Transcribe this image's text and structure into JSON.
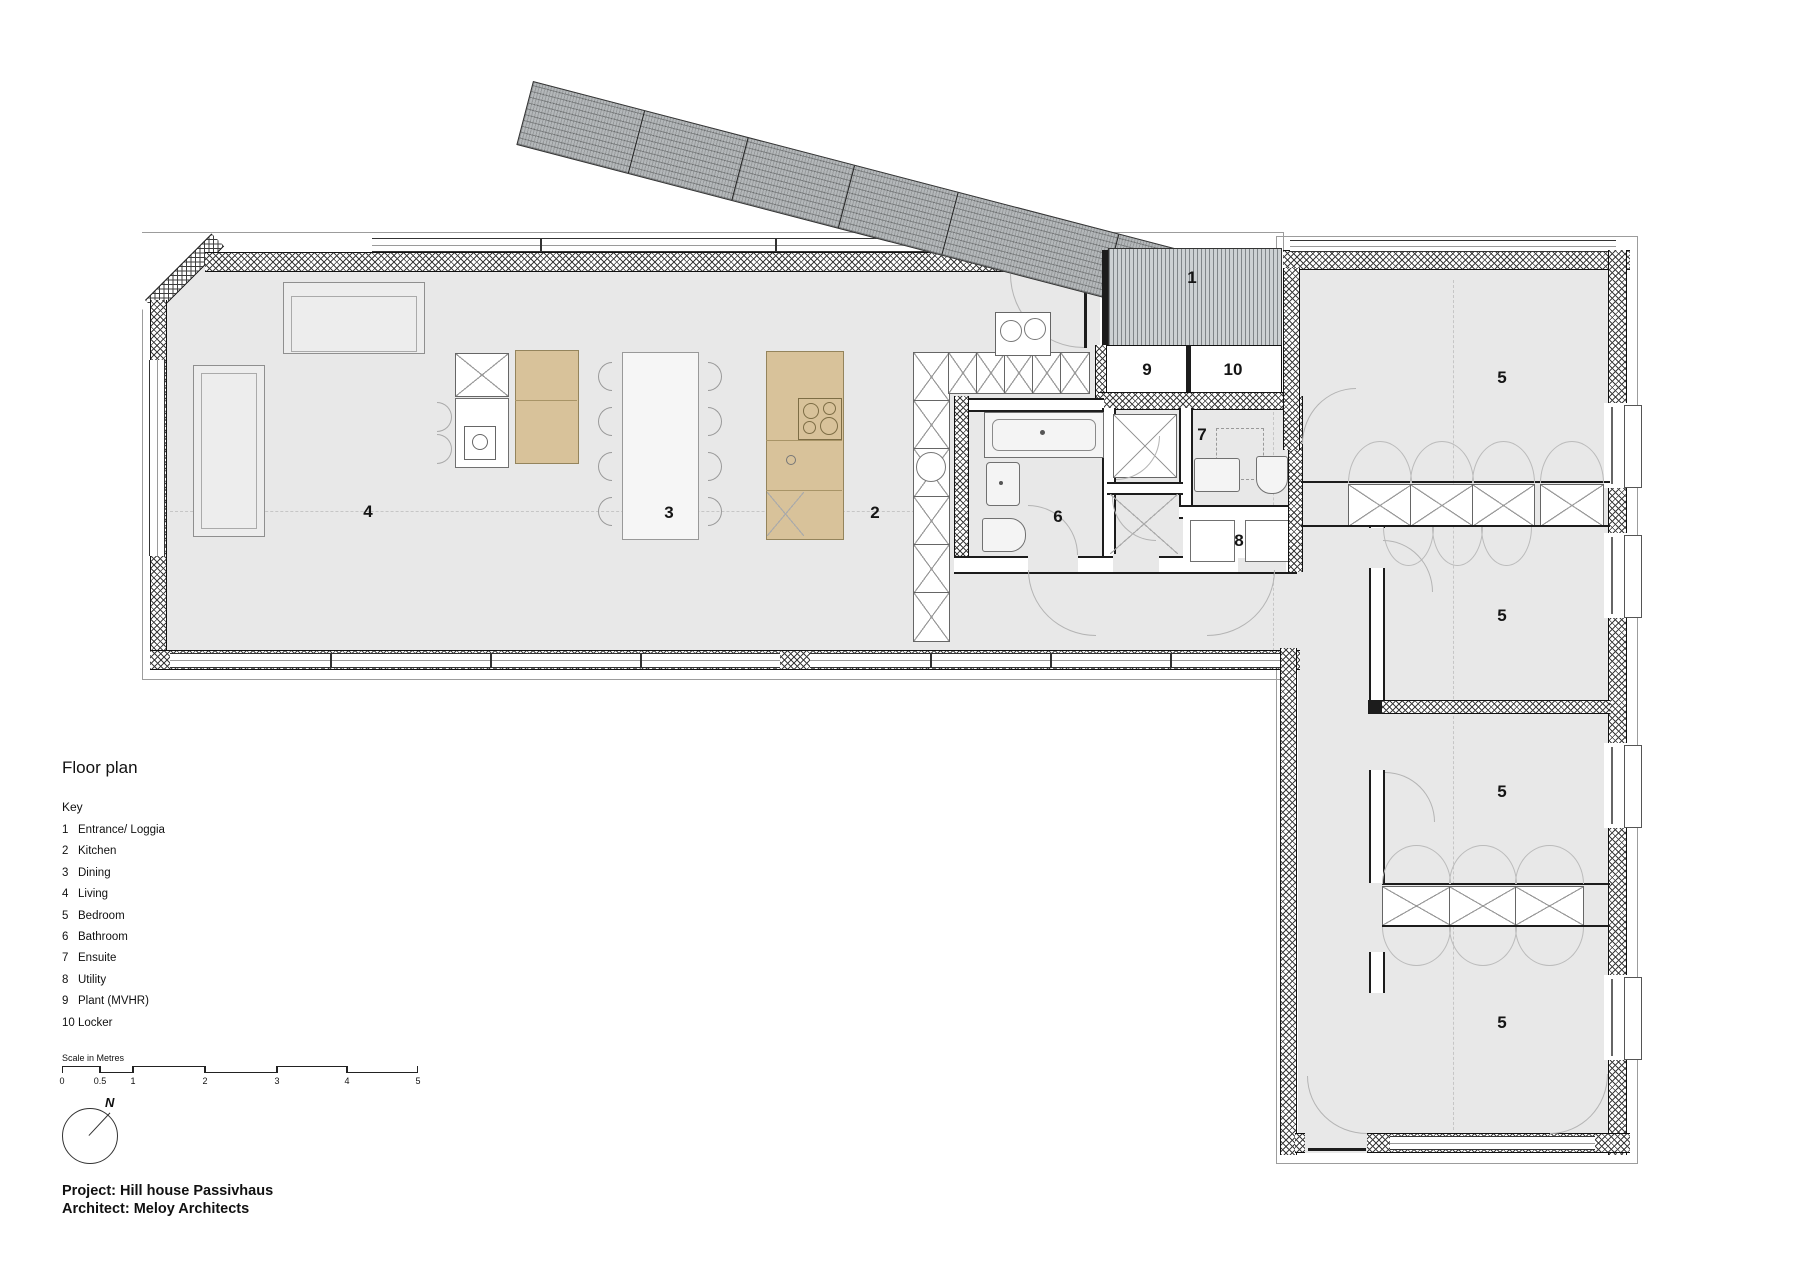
{
  "title": "Floor plan",
  "key": {
    "heading": "Key",
    "items": [
      {
        "num": "1",
        "label": "Entrance/ Loggia"
      },
      {
        "num": "2",
        "label": "Kitchen"
      },
      {
        "num": "3",
        "label": "Dining"
      },
      {
        "num": "4",
        "label": "Living"
      },
      {
        "num": "5",
        "label": "Bedroom"
      },
      {
        "num": "6",
        "label": "Bathroom"
      },
      {
        "num": "7",
        "label": "Ensuite"
      },
      {
        "num": "8",
        "label": "Utility"
      },
      {
        "num": "9",
        "label": "Plant (MVHR)"
      },
      {
        "num": "10",
        "label": "Locker"
      }
    ]
  },
  "scale_bar": {
    "label": "Scale in Metres",
    "ticks": [
      "0",
      "0.5",
      "1",
      "2",
      "3",
      "4",
      "5"
    ]
  },
  "north": {
    "label": "N"
  },
  "plan": {
    "room_labels": {
      "entrance": "1",
      "kitchen": "2",
      "dining": "3",
      "living": "4",
      "bedroom": "5",
      "bathroom": "6",
      "ensuite": "7",
      "utility": "8",
      "plant": "9",
      "locker": "10"
    }
  },
  "footer": {
    "project": "Project: Hill house Passivhaus",
    "architect": "Architect: Meloy Architects"
  },
  "colors": {
    "floor": "#e8e8e8",
    "timber": "#d8c29a",
    "canopy": "#b4b8ba",
    "deck": "#cdd1d3",
    "wall": "#111111"
  }
}
